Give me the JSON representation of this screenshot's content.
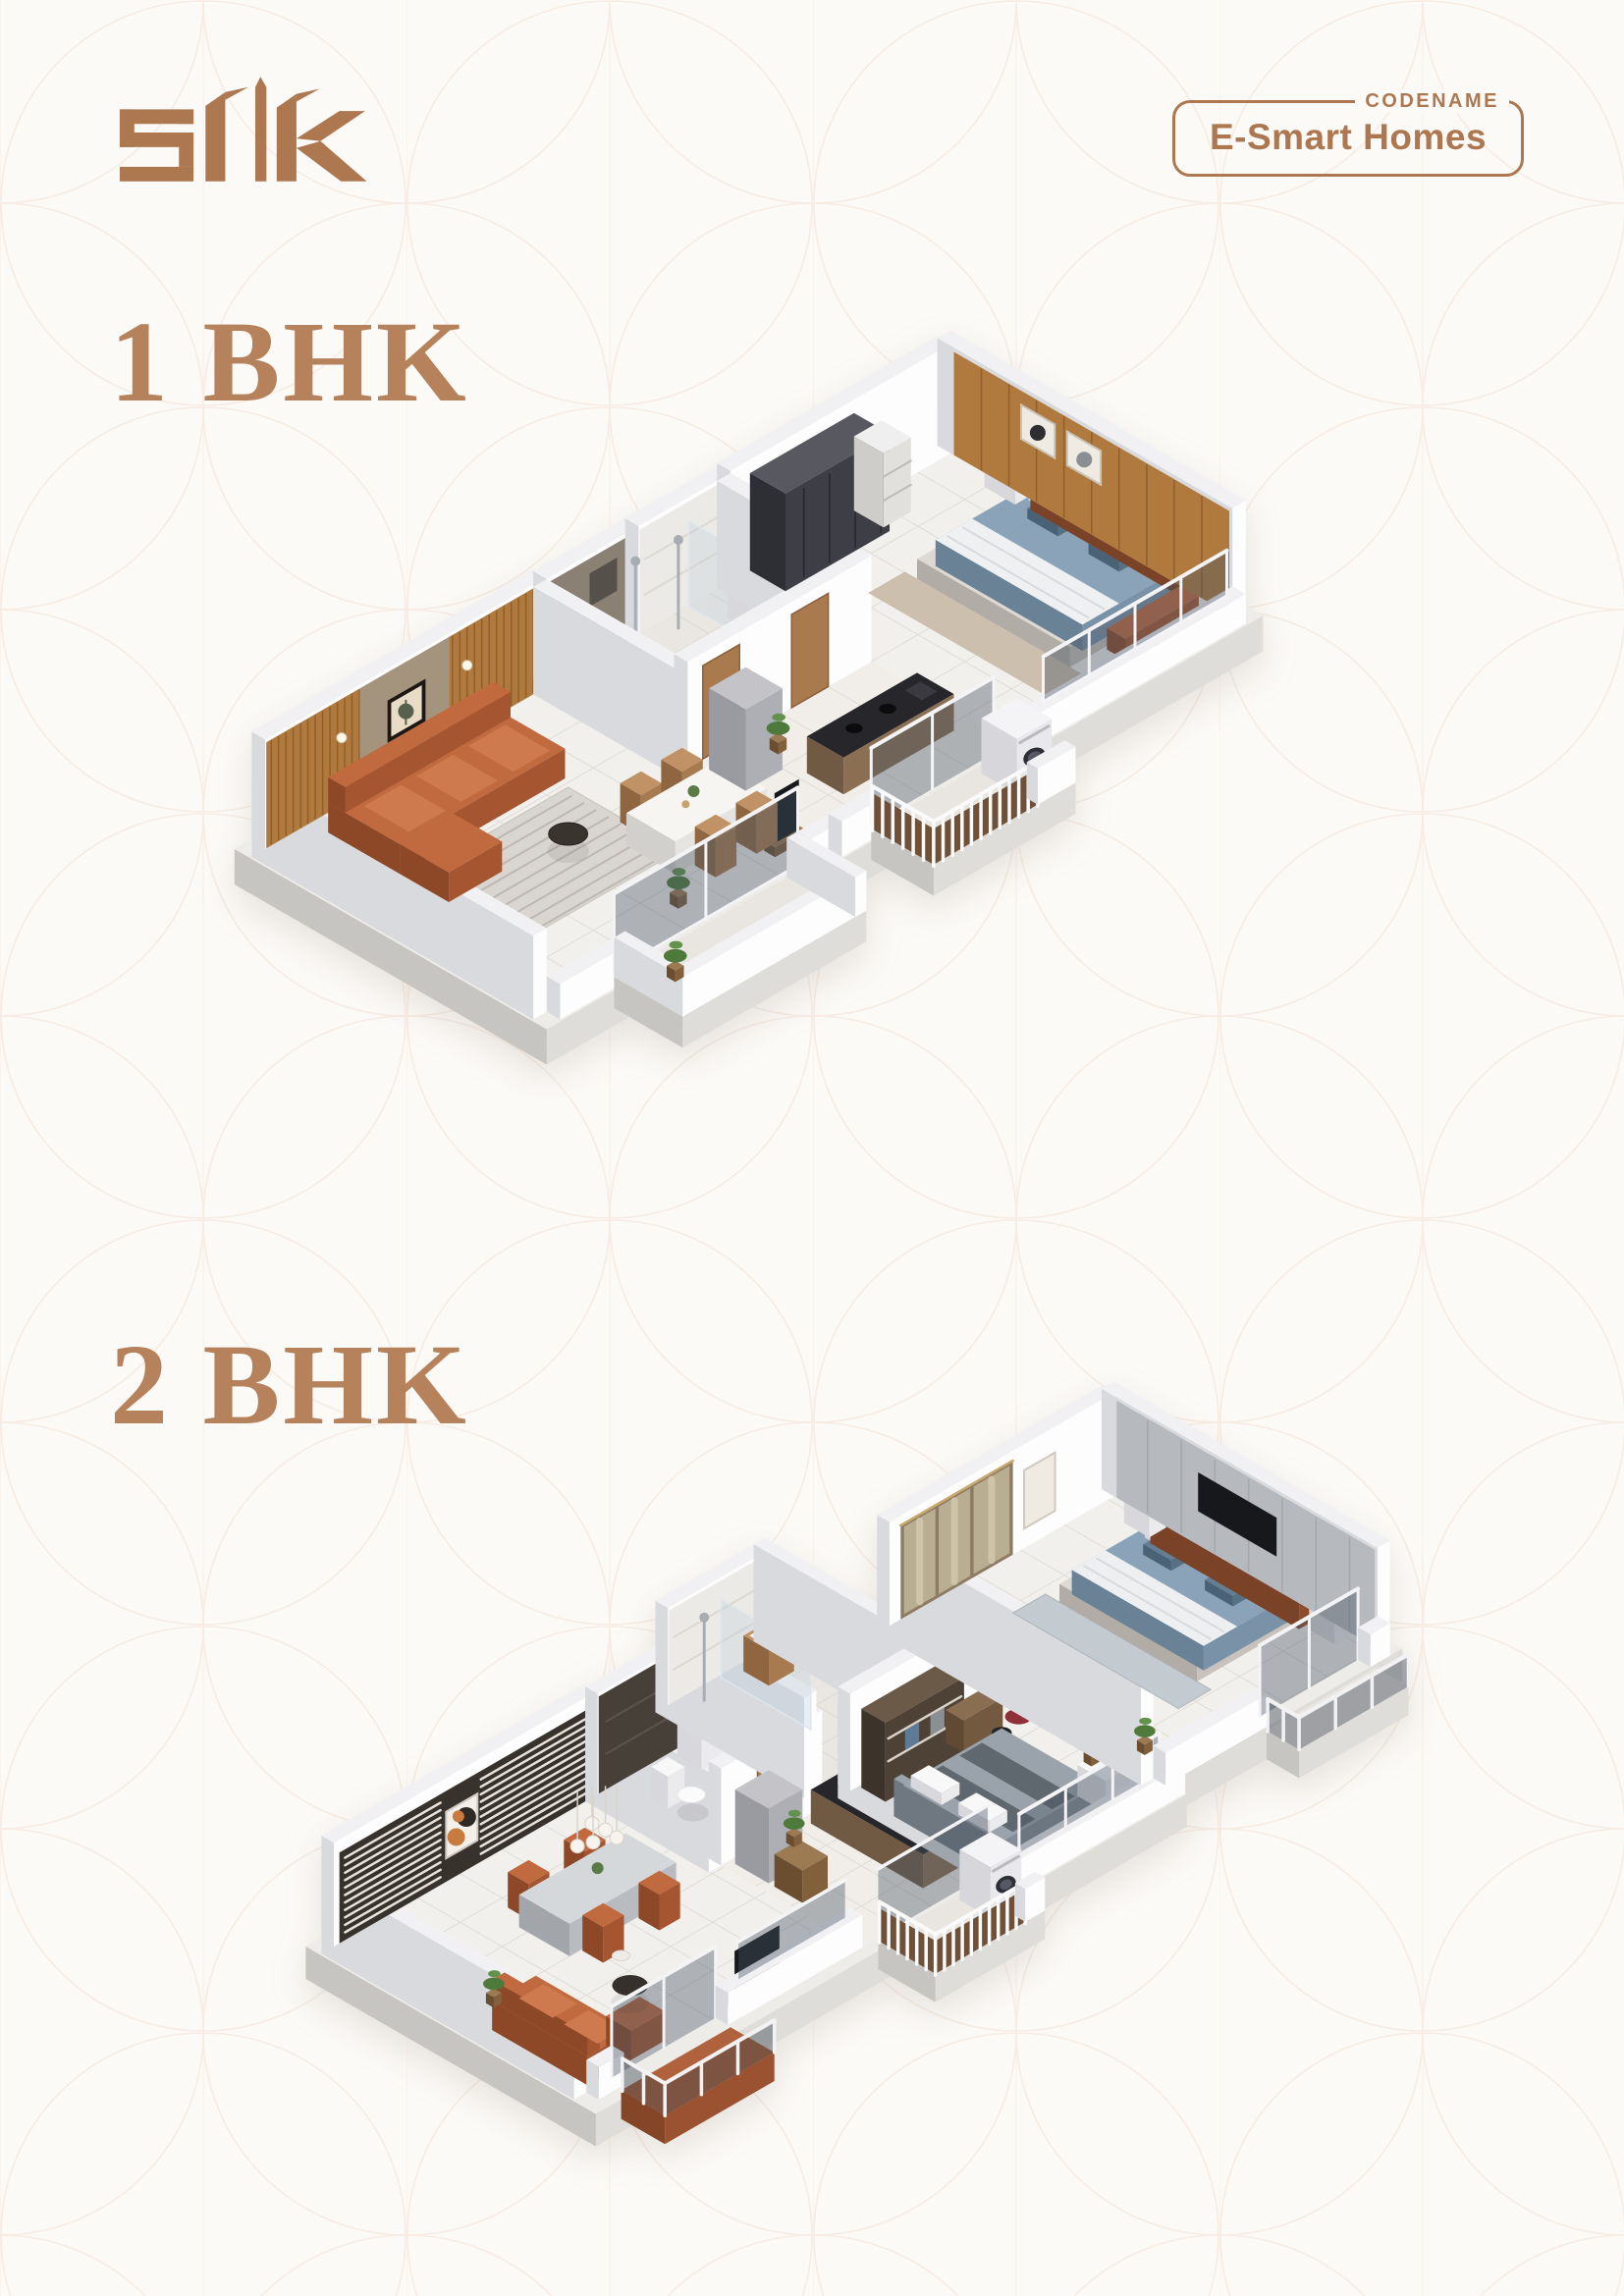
{
  "page": {
    "background_color": "#fcfaf7",
    "accent_color": "#ad7850",
    "heading_color": "#b5825c",
    "pattern_line_color": "#f2e4d8"
  },
  "header": {
    "logo_text": "slk",
    "badge": {
      "eyebrow": "CODENAME",
      "title": "E-Smart Homes"
    }
  },
  "sections": [
    {
      "label": "1 BHK"
    },
    {
      "label": "2 BHK"
    }
  ],
  "floor_plans": [
    {
      "alt": "1 BHK apartment 3D isometric floor plan"
    },
    {
      "alt": "2 BHK apartment 3D isometric floor plan"
    }
  ]
}
